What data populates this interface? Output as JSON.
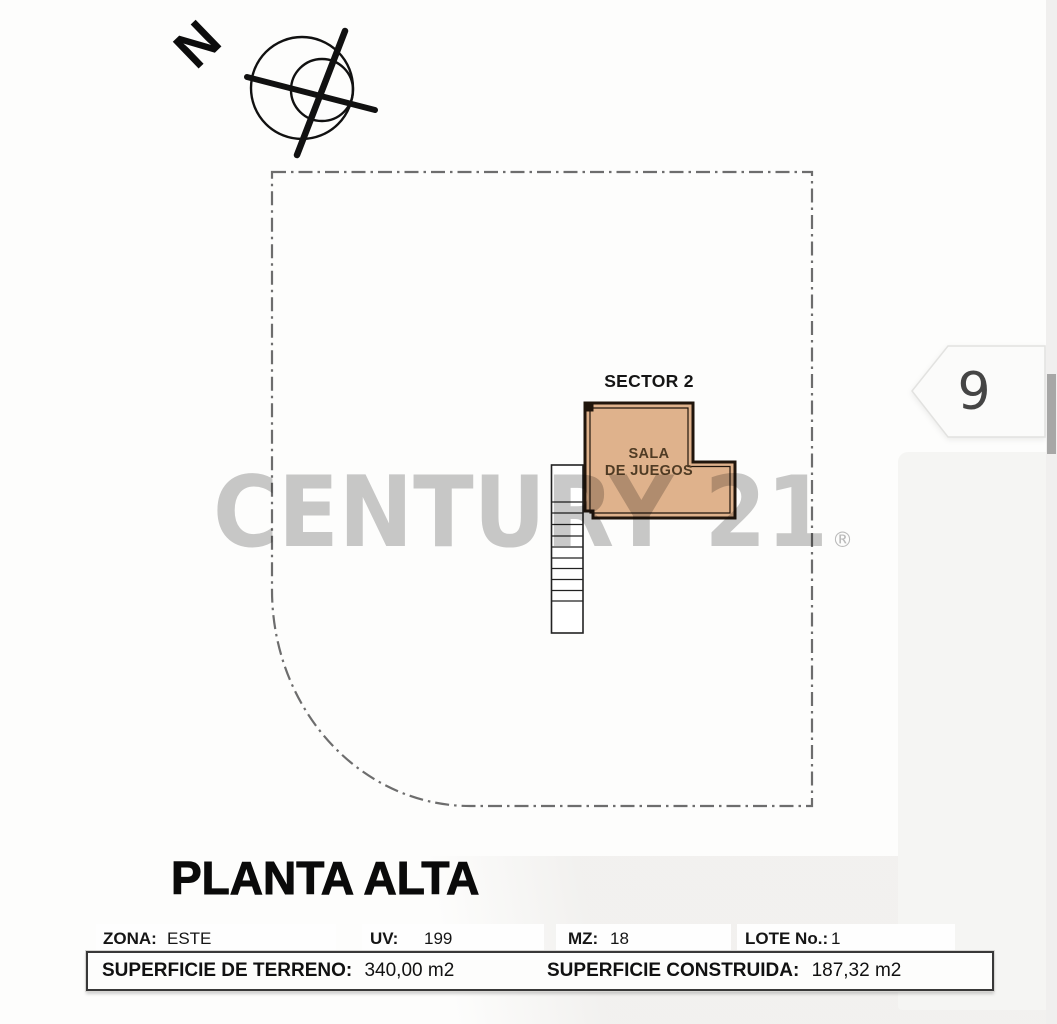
{
  "compass": {
    "n_label": "N"
  },
  "plan": {
    "sector_label": "SECTOR 2",
    "room": {
      "name_line1": "SALA",
      "name_line2": "DE JUEGOS"
    }
  },
  "watermark": {
    "text": "CENTURY 21",
    "registered": "®"
  },
  "page_marker": {
    "number": "9"
  },
  "title": "PLANTA ALTA",
  "info_table": {
    "row1": [
      {
        "label": "ZONA:",
        "value": "ESTE"
      },
      {
        "label": "UV:",
        "value": "199"
      },
      {
        "label": "MZ:",
        "value": "18"
      },
      {
        "label": "LOTE No.:",
        "value": "1"
      }
    ],
    "row2": [
      {
        "label": "SUPERFICIE DE TERRENO:",
        "value": "340,00 m2"
      },
      {
        "label": "SUPERFICIE CONSTRUIDA:",
        "value": "187,32 m2"
      }
    ]
  },
  "colors": {
    "room_fill": "#dfb28c",
    "room_border": "#20150c",
    "room_text": "#4f3b24",
    "boundary_dash": "#6d6d6d",
    "watermark_gray": "#c9c9c9"
  }
}
